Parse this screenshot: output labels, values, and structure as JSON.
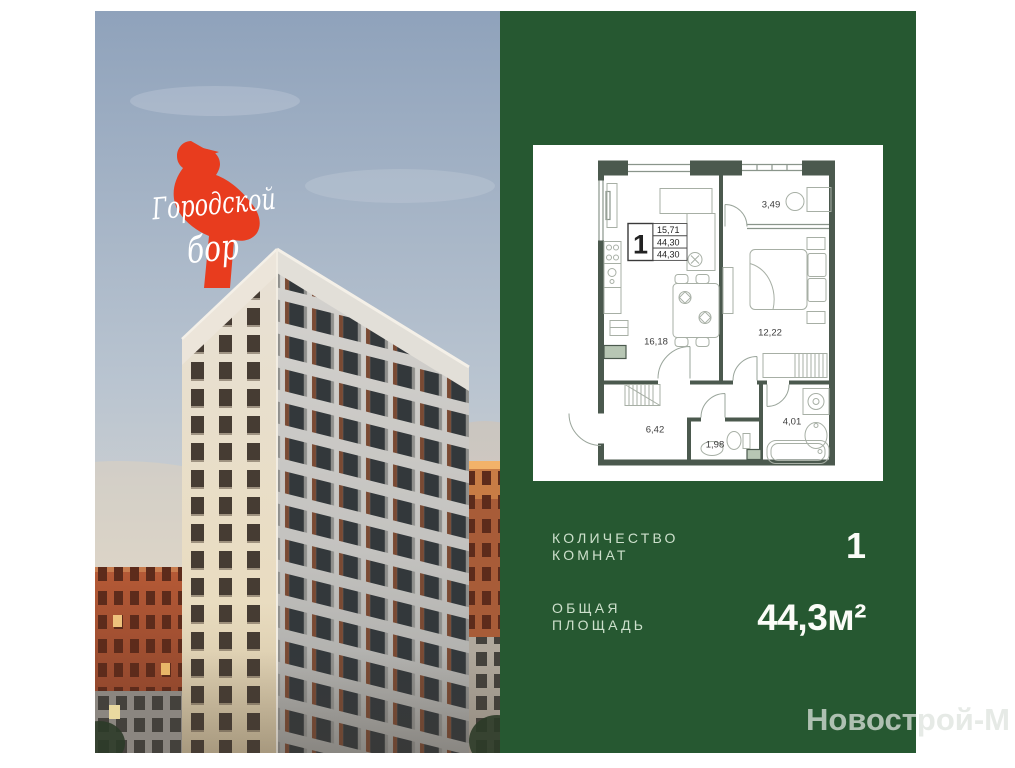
{
  "card": {
    "background": "#ffffff"
  },
  "photo": {
    "description": "residential-towers-at-dusk",
    "logo": {
      "line1": "Городской",
      "line2": "бор",
      "text_color": "#ffffff",
      "bird_color": "#e83c1e"
    }
  },
  "panel": {
    "background": "#265831",
    "floor_plan": {
      "rooms_badge": "1",
      "stats": [
        "15,71",
        "44,30",
        "44,30"
      ],
      "areas": {
        "loggia": "3,49",
        "kitchen_living": "16,18",
        "bedroom": "12,22",
        "hallway": "6,42",
        "wc": "1,98",
        "bathroom": "4,01"
      }
    },
    "specs": [
      {
        "label1": "КОЛИЧЕСТВО",
        "label2": "КОМНАТ",
        "value": "1"
      },
      {
        "label1": "ОБЩАЯ",
        "label2": "ПЛОЩАДЬ",
        "value": "44,3м²"
      }
    ]
  },
  "watermark": "Новострой-М"
}
